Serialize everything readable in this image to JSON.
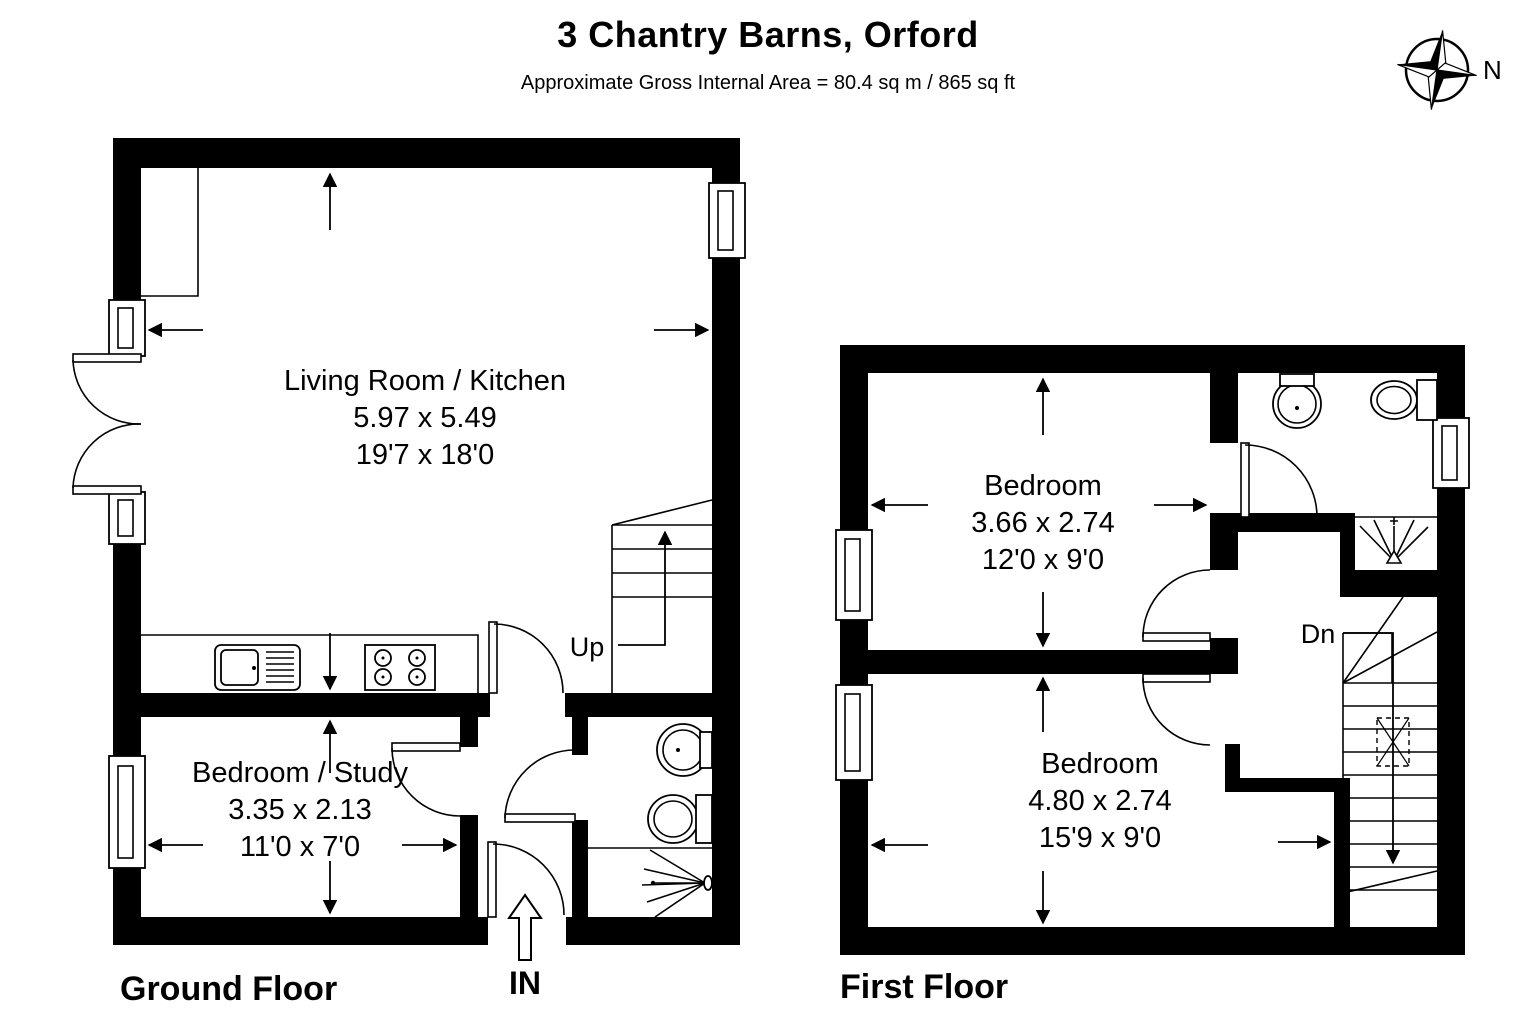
{
  "header": {
    "title": "3 Chantry Barns, Orford",
    "subtitle": "Approximate Gross Internal Area = 80.4 sq m / 865 sq ft"
  },
  "compass": {
    "north_label": "N"
  },
  "ground_floor": {
    "label": "Ground Floor",
    "stairs_label": "Up",
    "entrance_label": "IN",
    "rooms": {
      "living_kitchen": {
        "name": "Living Room / Kitchen",
        "metric": "5.97 x 5.49",
        "imperial": "19'7 x 18'0"
      },
      "bedroom_study": {
        "name": "Bedroom / Study",
        "metric": "3.35 x 2.13",
        "imperial": "11'0 x 7'0"
      }
    }
  },
  "first_floor": {
    "label": "First Floor",
    "stairs_label": "Dn",
    "rooms": {
      "bedroom_front": {
        "name": "Bedroom",
        "metric": "3.66 x 2.74",
        "imperial": "12'0 x 9'0"
      },
      "bedroom_back": {
        "name": "Bedroom",
        "metric": "4.80 x 2.74",
        "imperial": "15'9 x 9'0"
      }
    }
  },
  "colors": {
    "wall": "#000000",
    "background": "#ffffff",
    "line": "#000000"
  }
}
